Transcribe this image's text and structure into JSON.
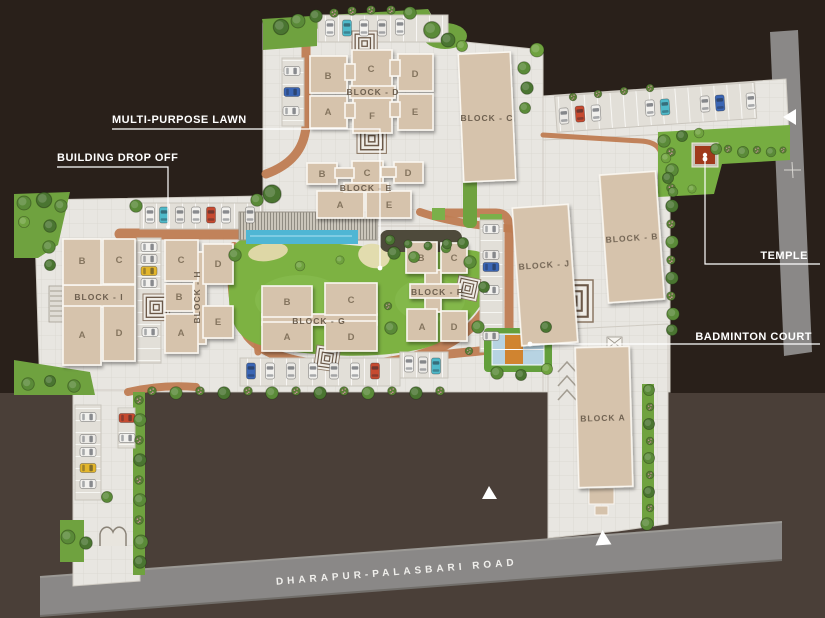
{
  "annotations": {
    "multi_purpose_lawn": "MULTI-PURPOSE LAWN",
    "building_drop_off": "BUILDING DROP OFF",
    "temple": "TEMPLE",
    "badminton_court": "BADMINTON COURT"
  },
  "roads": {
    "main_road_name": "DHARAPUR-PALASBARI ROAD"
  },
  "blocks": {
    "a": {
      "label": "BLOCK A"
    },
    "b": {
      "label": "BLOCK - B"
    },
    "c": {
      "label": "BLOCK - C"
    },
    "d": {
      "label": "BLOCK - D",
      "units": {
        "a": "A",
        "b": "B",
        "c": "C",
        "d": "D",
        "e": "E",
        "f": "F"
      }
    },
    "e": {
      "label": "BLOCK - E",
      "units": {
        "a": "A",
        "b": "B",
        "c": "C",
        "d": "D",
        "e": "E"
      }
    },
    "f": {
      "label": "BLOCK - F",
      "units": {
        "a": "A",
        "b": "B",
        "c": "C",
        "d": "D"
      }
    },
    "g": {
      "label": "BLOCK - G",
      "units": {
        "a": "A",
        "b": "B",
        "c": "C",
        "d": "D"
      }
    },
    "h": {
      "label": "BLOCK - H",
      "units": {
        "a": "A",
        "b": "B",
        "c": "C",
        "d": "D",
        "e": "E"
      }
    },
    "i": {
      "label": "BLOCK - I",
      "units": {
        "a": "A",
        "b": "B",
        "c": "C",
        "d": "D"
      }
    },
    "j": {
      "label": "BLOCK - J"
    }
  },
  "colors": {
    "background_top": "#29201a",
    "background_bottom": "#4a3f38",
    "paving": "#e8e6e1",
    "building": "#d6c3ac",
    "lawn": "#7db242",
    "brick_path": "#bf7c52",
    "road_gray": "#8a8887",
    "water": "#4fb6d4",
    "temple_red": "#a03a1c",
    "court_blue": "#b7d3e2",
    "court_orange": "#d08430",
    "car_white": "#f2f1ee",
    "car_red": "#c64a30",
    "car_blue": "#3b66b5",
    "car_teal": "#4fb9c9",
    "car_yellow": "#e3b62c",
    "annotation_text": "#ffffff"
  }
}
